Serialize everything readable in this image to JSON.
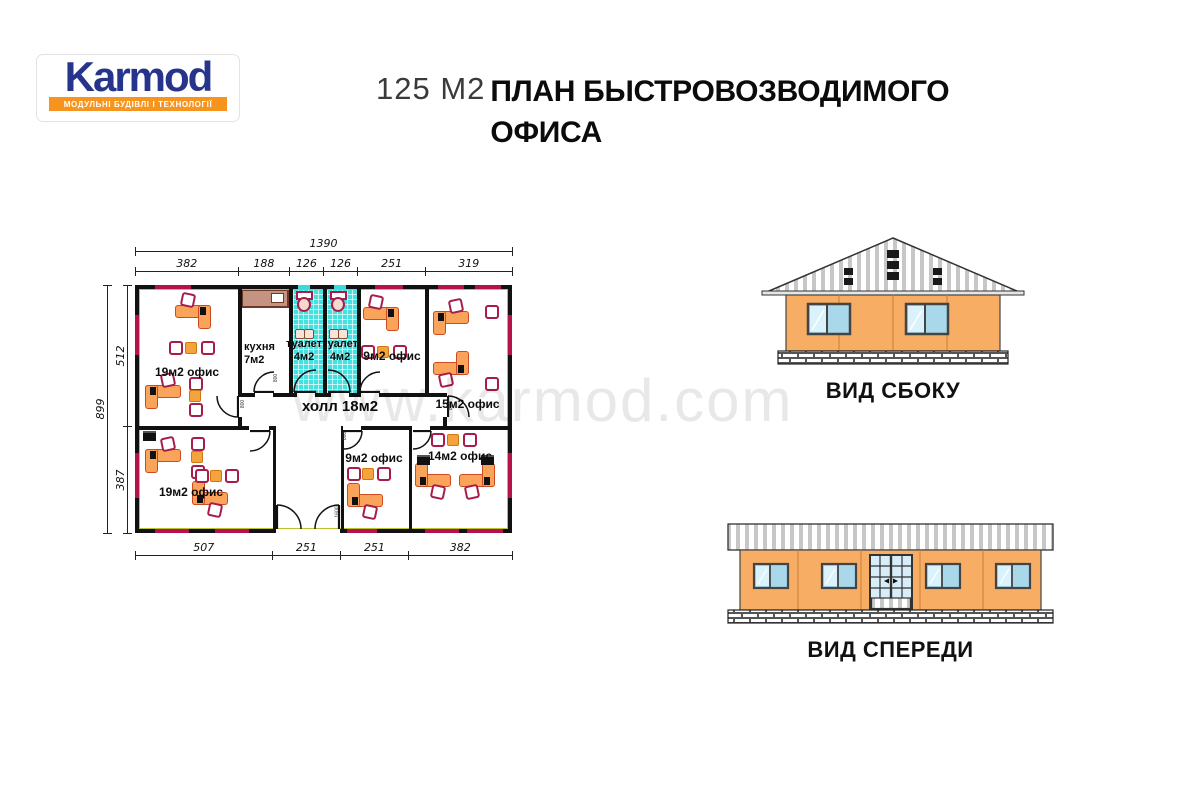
{
  "logo": {
    "brand": "Karmod",
    "tagline": "МОДУЛЬНІ БУДІВЛІ І ТЕХНОЛОГІЇ"
  },
  "title": {
    "area": "125 М2",
    "line1": "ПЛАН БЫСТРОВОЗВОДИМОГО",
    "line2": "ОФИСА"
  },
  "watermark": "www.karmod.com",
  "plan": {
    "rooms": {
      "office_top_left": "19м2 офис",
      "kitchen": {
        "name": "кухня",
        "area": "7м2"
      },
      "toilet_left": {
        "name": "туалет",
        "area": "4м2"
      },
      "toilet_right": {
        "name": "туалет",
        "area": "4м2"
      },
      "office_top_middle": "9м2 офис",
      "office_top_right": "15м2 офис",
      "hall": "холл 18м2",
      "office_bottom_left": "19м2 офис",
      "office_bottom_middle": "9м2 офис",
      "office_bottom_right": "14м2 офис"
    },
    "dimensions": {
      "top_total": "1390",
      "top_segments": [
        "382",
        "188",
        "126",
        "126",
        "251",
        "319"
      ],
      "bottom_segments": [
        "507",
        "251",
        "251",
        "382"
      ],
      "left_total": "899",
      "left_segments": [
        "512",
        "387"
      ],
      "door_width_label": "800",
      "entrance_width_label": "1600"
    }
  },
  "elevations": {
    "side_label": "ВИД СБОКУ",
    "front_label": "ВИД СПЕРЕДИ"
  },
  "colors": {
    "logo_blue": "#27348b",
    "logo_orange": "#f7941d",
    "desk_orange": "#f9a45a",
    "desk_border": "#cf4a1f",
    "chair_crimson": "#a81c4a",
    "window_crimson": "#b5124b",
    "wall_lime": "#b9c42c",
    "tile_teal": "#45e0e0",
    "facade_orange": "#f8ad64",
    "glass_blue": "#a9d8ea",
    "watermark_gray": "#d9d9d9"
  }
}
